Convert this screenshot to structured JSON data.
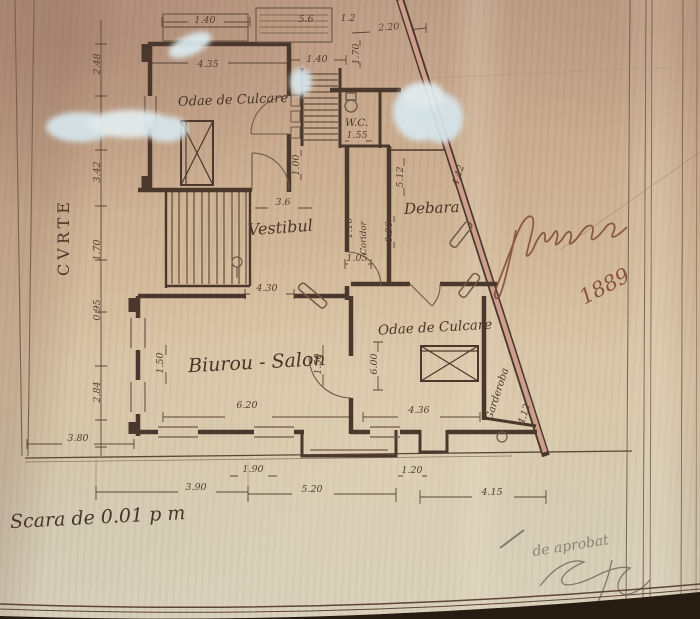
{
  "colors": {
    "paper_base": "#c9ab8e",
    "ink": "#4b382c",
    "pink_wall": "#cf9f8e",
    "whiteout": "#d6e6ec",
    "pencil": "#6f675c",
    "signature_ink": "#7d4a36"
  },
  "plan": {
    "rooms": {
      "room_top_left": "Odae de Culcare",
      "wc": "W.C.",
      "vestibul": "Vestibul",
      "debara": "Debara",
      "room_right": "Odae de Culcare",
      "salon": "Biurou - Salon",
      "coridor": "Coridor",
      "garderoba": "Garderoba",
      "courtyard": "CVRTE"
    },
    "scale_note": "Scara de 0.01 p m",
    "year": "1889",
    "approval_note": "de aprobat",
    "dimensions": [
      {
        "t": "1.40",
        "x": 205,
        "y": 23,
        "r": 0
      },
      {
        "t": "4.35",
        "x": 208,
        "y": 67,
        "r": 0
      },
      {
        "t": "1.40",
        "x": 317,
        "y": 62,
        "r": 0
      },
      {
        "t": "5.6",
        "x": 306,
        "y": 22,
        "r": 0
      },
      {
        "t": "1.2",
        "x": 348,
        "y": 21,
        "r": 0
      },
      {
        "t": "2.20",
        "x": 389,
        "y": 30,
        "r": -4
      },
      {
        "t": "1.70",
        "x": 359,
        "y": 54,
        "r": -90
      },
      {
        "t": "1.00",
        "x": 299,
        "y": 165,
        "r": -90
      },
      {
        "t": "1.55",
        "x": 357,
        "y": 138,
        "r": 0
      },
      {
        "t": "3.6",
        "x": 283,
        "y": 205,
        "r": 0
      },
      {
        "t": "1.05",
        "x": 357,
        "y": 261,
        "r": 0
      },
      {
        "t": "4.30",
        "x": 267,
        "y": 291,
        "r": 0
      },
      {
        "t": "1.10",
        "x": 352,
        "y": 228,
        "r": -90
      },
      {
        "t": "0.96",
        "x": 392,
        "y": 232,
        "r": -90
      },
      {
        "t": "5.12",
        "x": 403,
        "y": 177,
        "r": -90
      },
      {
        "t": "4.42",
        "x": 461,
        "y": 176,
        "r": -72
      },
      {
        "t": "4.12",
        "x": 527,
        "y": 415,
        "r": -72
      },
      {
        "t": "6.00",
        "x": 377,
        "y": 364,
        "r": -90
      },
      {
        "t": "1.50",
        "x": 163,
        "y": 363,
        "r": -90
      },
      {
        "t": "1.50",
        "x": 321,
        "y": 364,
        "r": -90
      },
      {
        "t": "6.20",
        "x": 247,
        "y": 408,
        "r": 0
      },
      {
        "t": "4.36",
        "x": 419,
        "y": 413,
        "r": 0
      },
      {
        "t": "1.90",
        "x": 253,
        "y": 472,
        "r": 0
      },
      {
        "t": "1.20",
        "x": 412,
        "y": 473,
        "r": 0
      },
      {
        "t": "3.90",
        "x": 196,
        "y": 490,
        "r": 0
      },
      {
        "t": "5.20",
        "x": 312,
        "y": 492,
        "r": 0
      },
      {
        "t": "4.15",
        "x": 492,
        "y": 495,
        "r": 0
      },
      {
        "t": "3.80",
        "x": 78,
        "y": 441,
        "r": 0
      },
      {
        "t": "2.84",
        "x": 100,
        "y": 392,
        "r": -90
      },
      {
        "t": "2.48",
        "x": 100,
        "y": 64,
        "r": -90
      },
      {
        "t": "3.42",
        "x": 100,
        "y": 172,
        "r": -90
      },
      {
        "t": "1.70",
        "x": 100,
        "y": 250,
        "r": -90
      },
      {
        "t": "0.95",
        "x": 100,
        "y": 310,
        "r": -90
      }
    ]
  }
}
